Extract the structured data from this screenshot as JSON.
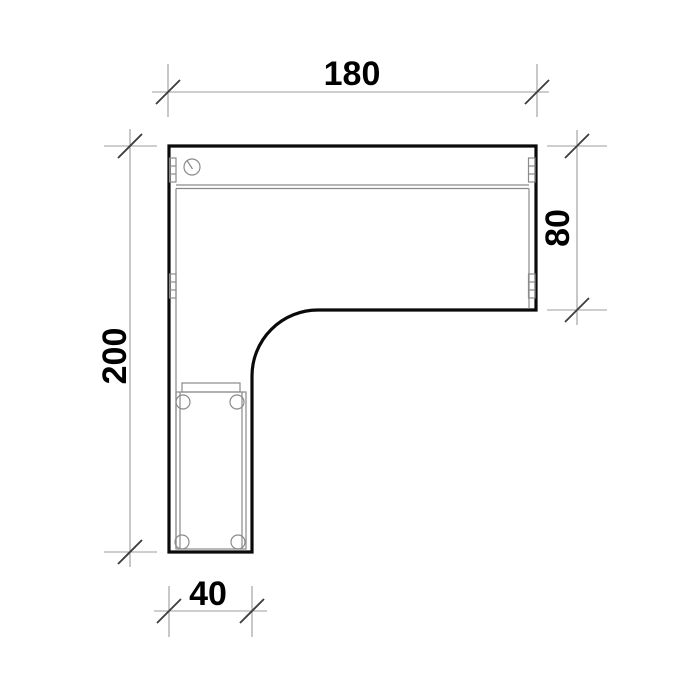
{
  "drawing": {
    "type": "furniture-plan-top-view",
    "subject": "l-shaped-corner-desk",
    "dimensions": {
      "top": {
        "value": "180"
      },
      "left": {
        "value": "200"
      },
      "right": {
        "value": "80"
      },
      "bottom": {
        "value": "40"
      }
    },
    "colors": {
      "outline": "#0a0a0a",
      "detail": "#8a8a8a",
      "dimension": "#9c9c9c",
      "tick": "#3f3f3f",
      "text": "#000000",
      "background": "#ffffff"
    }
  }
}
